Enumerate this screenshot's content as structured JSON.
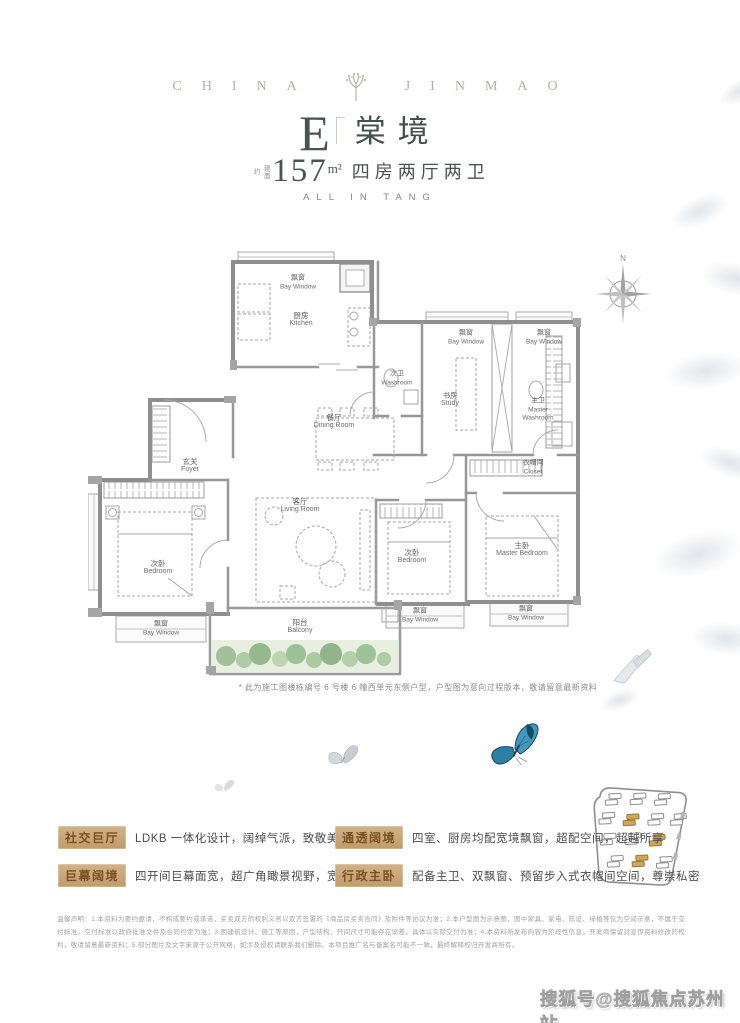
{
  "brand": {
    "left": "CHINA",
    "right": "JINMAO"
  },
  "title": {
    "type_letter": "E",
    "name": "棠境",
    "area_prefix": "建面约",
    "area_value": "157",
    "area_unit": "m²",
    "spec": "四房两厅两卫",
    "tagline": "ALL IN TANG"
  },
  "floorplan": {
    "compass_label": "N",
    "note": "* 此为施工图楼栋编号 6 号楼 6 幢西单元东侧户型，户型图为意向过程版本，敬请留意最新资料",
    "rooms": [
      {
        "id": "bay-window-kitchen",
        "cn": "飘窗",
        "en": "Bay Window"
      },
      {
        "id": "kitchen",
        "cn": "厨房",
        "en": "Kitchen"
      },
      {
        "id": "washroom",
        "cn": "次卫",
        "en": "Washroom"
      },
      {
        "id": "bay-window-study",
        "cn": "飘窗",
        "en": "Bay Window"
      },
      {
        "id": "study",
        "cn": "书房",
        "en": "Study"
      },
      {
        "id": "bay-window-master-washroom",
        "cn": "飘窗",
        "en": "Bay Window"
      },
      {
        "id": "master-washroom",
        "cn": "主卫",
        "en": "Master Washroom"
      },
      {
        "id": "dining-room",
        "cn": "餐厅",
        "en": "Dining Room"
      },
      {
        "id": "foyer",
        "cn": "玄关",
        "en": "Foyer"
      },
      {
        "id": "living-room",
        "cn": "客厅",
        "en": "Living Room"
      },
      {
        "id": "closet",
        "cn": "衣帽间",
        "en": "Closet"
      },
      {
        "id": "bedroom-left",
        "cn": "次卧",
        "en": "Bedroom"
      },
      {
        "id": "bedroom-middle",
        "cn": "次卧",
        "en": "Bedroom"
      },
      {
        "id": "master-bedroom",
        "cn": "主卧",
        "en": "Master Bedroom"
      },
      {
        "id": "balcony",
        "cn": "阳台",
        "en": "Balcony"
      },
      {
        "id": "bay-window-left",
        "cn": "飘窗",
        "en": "Bay Window"
      },
      {
        "id": "bay-window-middle",
        "cn": "飘窗",
        "en": "Bay Window"
      },
      {
        "id": "bay-window-right",
        "cn": "飘窗",
        "en": "Bay Window"
      }
    ]
  },
  "features": [
    {
      "tag": "社交巨厅",
      "desc": "LDKB 一体化设计，阔绰气派，致敬美满人生"
    },
    {
      "tag": "通透阔境",
      "desc": "四室、厨房均配宽境飘窗，超配空间，超越所享"
    },
    {
      "tag": "巨幕阔境",
      "desc": "四开间巨幕面宽，超广角瞰景视野，宽藏无界风光"
    },
    {
      "tag": "行政主卧",
      "desc": "配备主卫、双飘窗、预留步入式衣帽间空间，尊崇私密"
    }
  ],
  "disclaimer": "温馨声明：1.本资料为要约邀请，不构成要约或承诺，买卖双方的权利义务以双方签署的《商品房买卖合同》及附件等协议为准；2.本户型图为示意图，图中家具、家电、陈设、绿植等仅为空间示意，不属于交付标准，交付标准以政府批准文件及合同约定为准；3.因建筑设计、施工等原因，户型结构、开间尺寸可能存在误差，具体以实际交付为准；4.本资料所发布内容为阶段性信息，开发商保留对宣传资料修改的权利，敬请留意最新资料；5.部分图片及文字来源于公开网络，如涉及侵权请联系我们删除。本项目推广名与备案名可能不一致，最终解释权归开发商所有。",
  "watermark": "搜狐号@搜狐焦点苏州站",
  "colors": {
    "accent_gold": "#c2a06e",
    "title_green_gray": "#45504b",
    "brand_gray": "#b7aea2",
    "butterfly_blue": "#2f85ad",
    "plan_wall": "#8f8f8f"
  }
}
